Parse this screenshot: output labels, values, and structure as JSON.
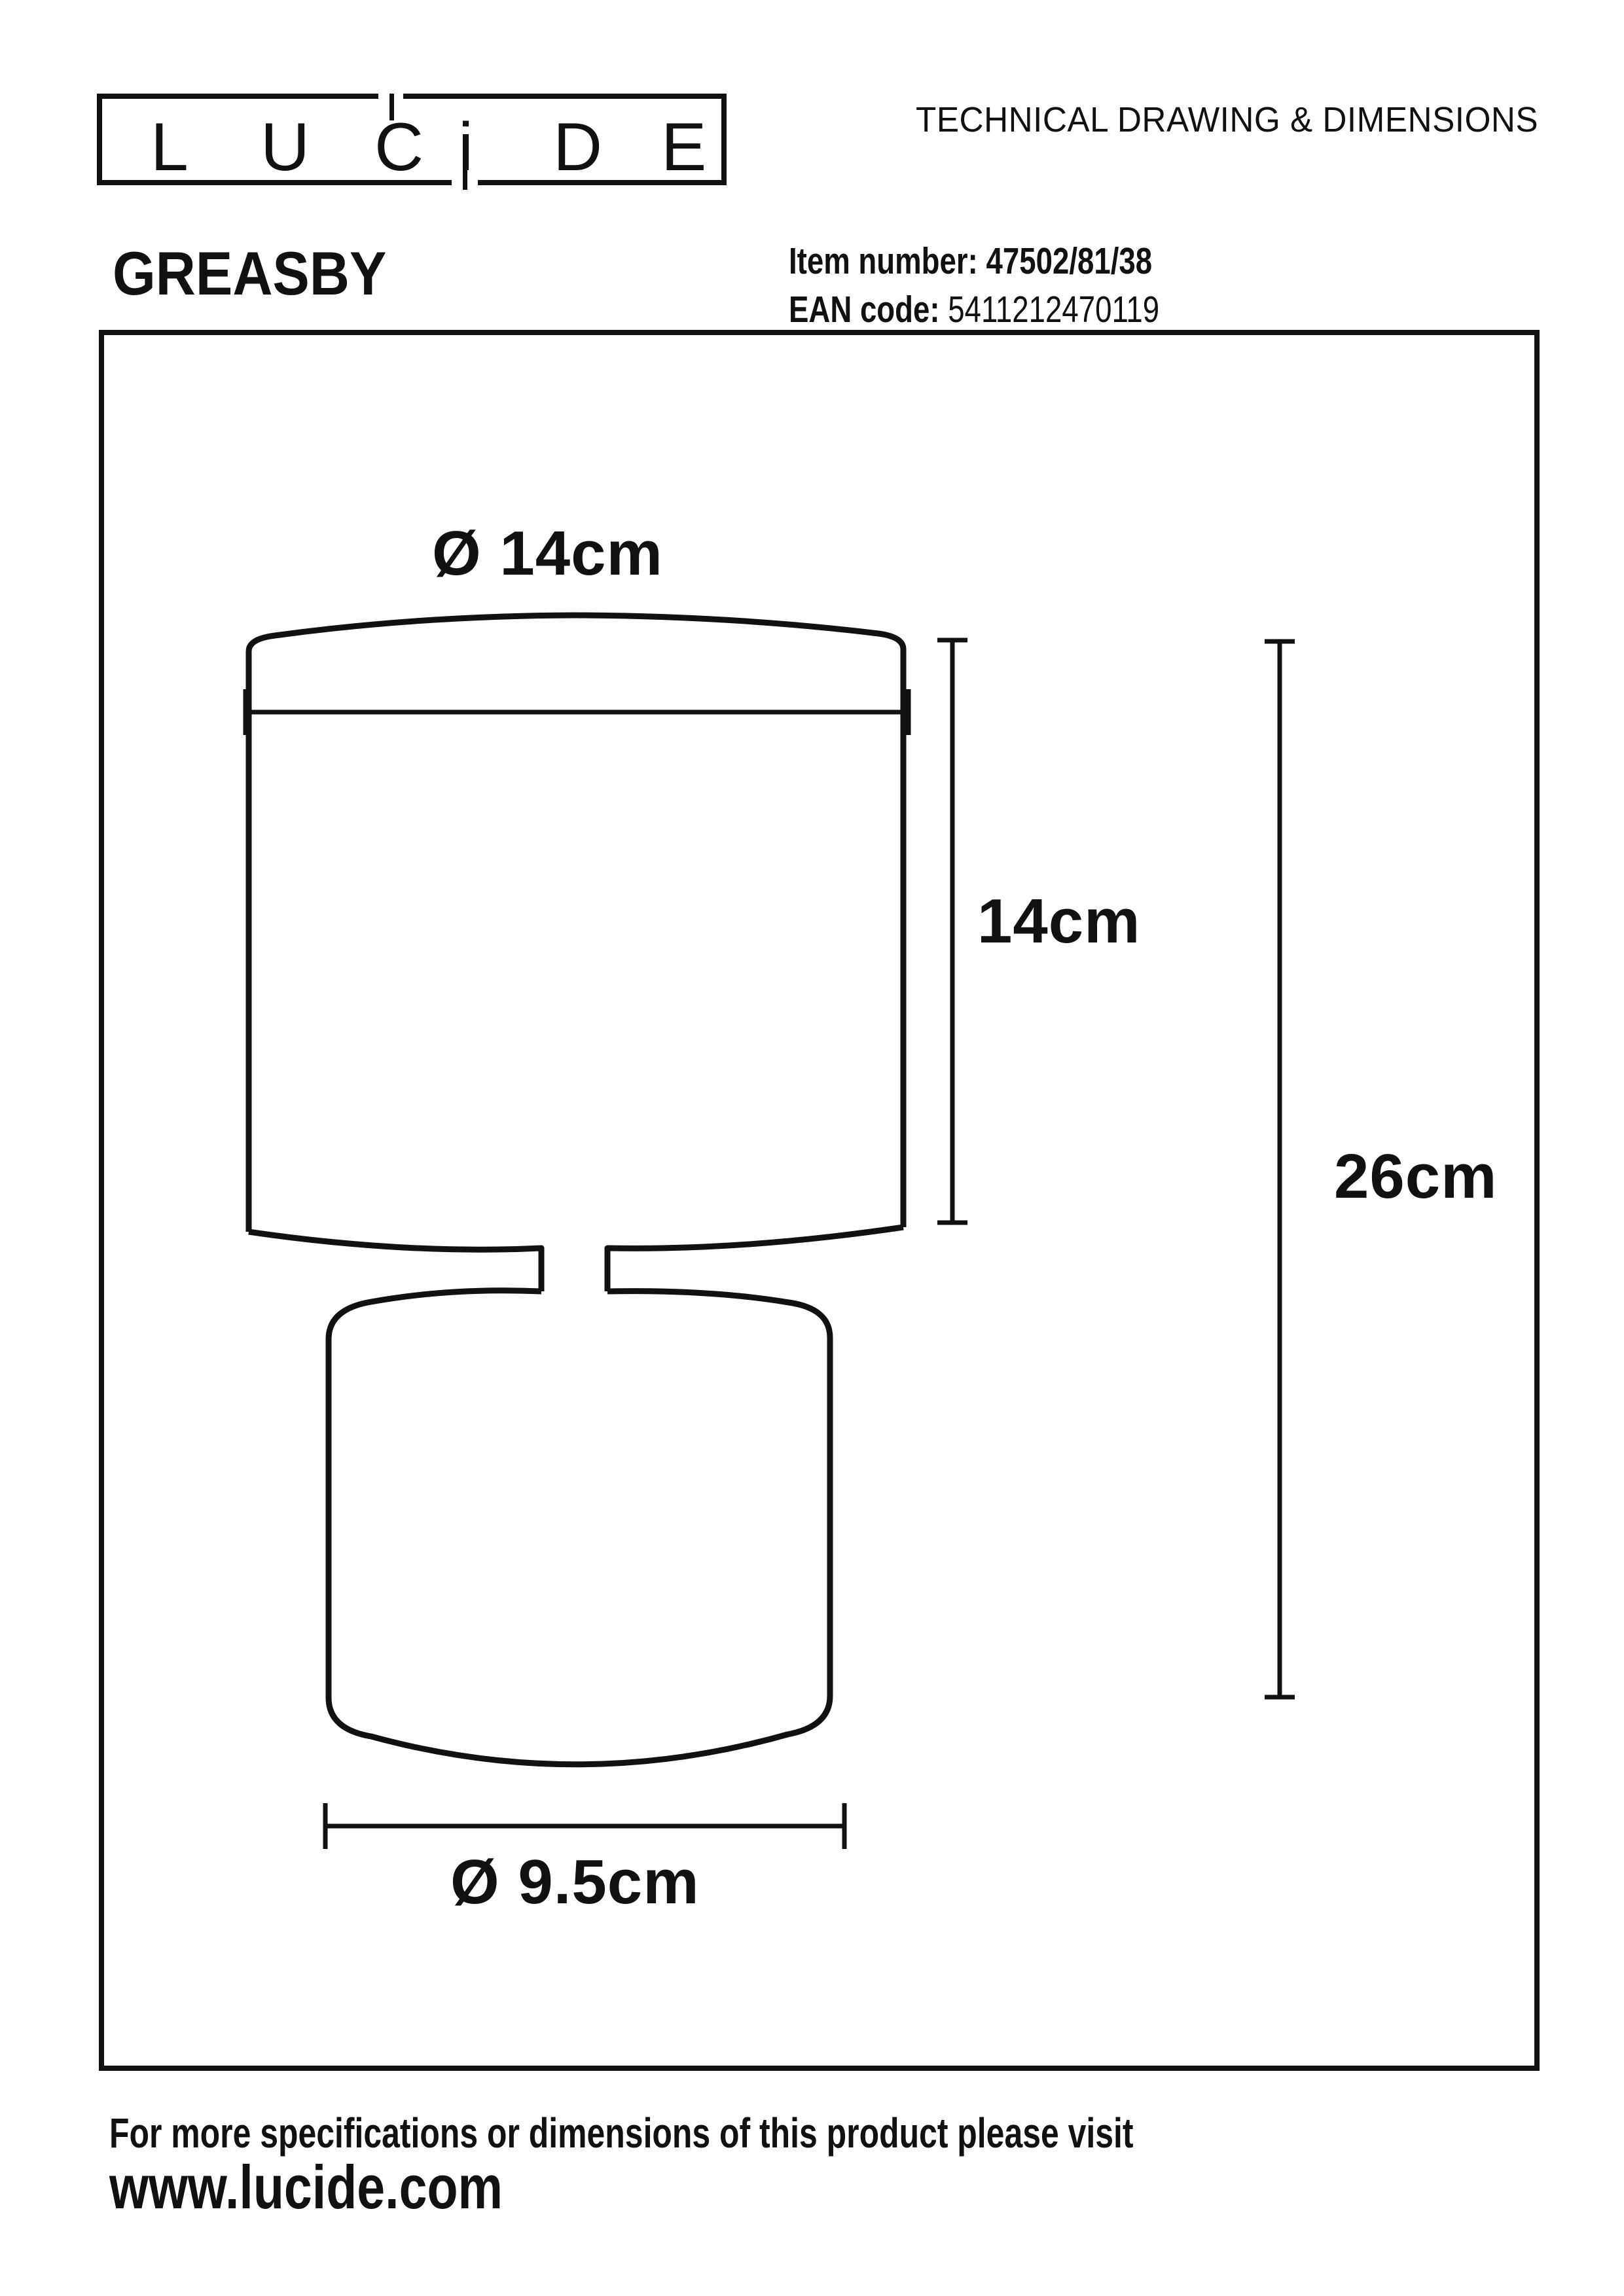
{
  "header": {
    "logo_letters": [
      "L",
      "U",
      "C",
      "i",
      "D",
      "E"
    ],
    "title": "TECHNICAL DRAWING & DIMENSIONS"
  },
  "product": {
    "name": "GREASBY",
    "item_number_label": "Item number:",
    "item_number_value": "47502/81/38",
    "ean_label": "EAN code:",
    "ean_value": "5411212470119"
  },
  "drawing": {
    "labels": {
      "top_diameter": "Ø 14cm",
      "shade_height": "14cm",
      "total_height": "26cm",
      "base_diameter": "Ø 9.5cm"
    },
    "dimensions_cm": {
      "shade_diameter": 14,
      "shade_height": 14,
      "total_height": 26,
      "base_diameter": 9.5
    }
  },
  "footer": {
    "line1": "For more specifications or dimensions of this product please visit",
    "line2": "www.lucide.com"
  },
  "colors": {
    "ink": "#111111",
    "background": "#ffffff"
  }
}
